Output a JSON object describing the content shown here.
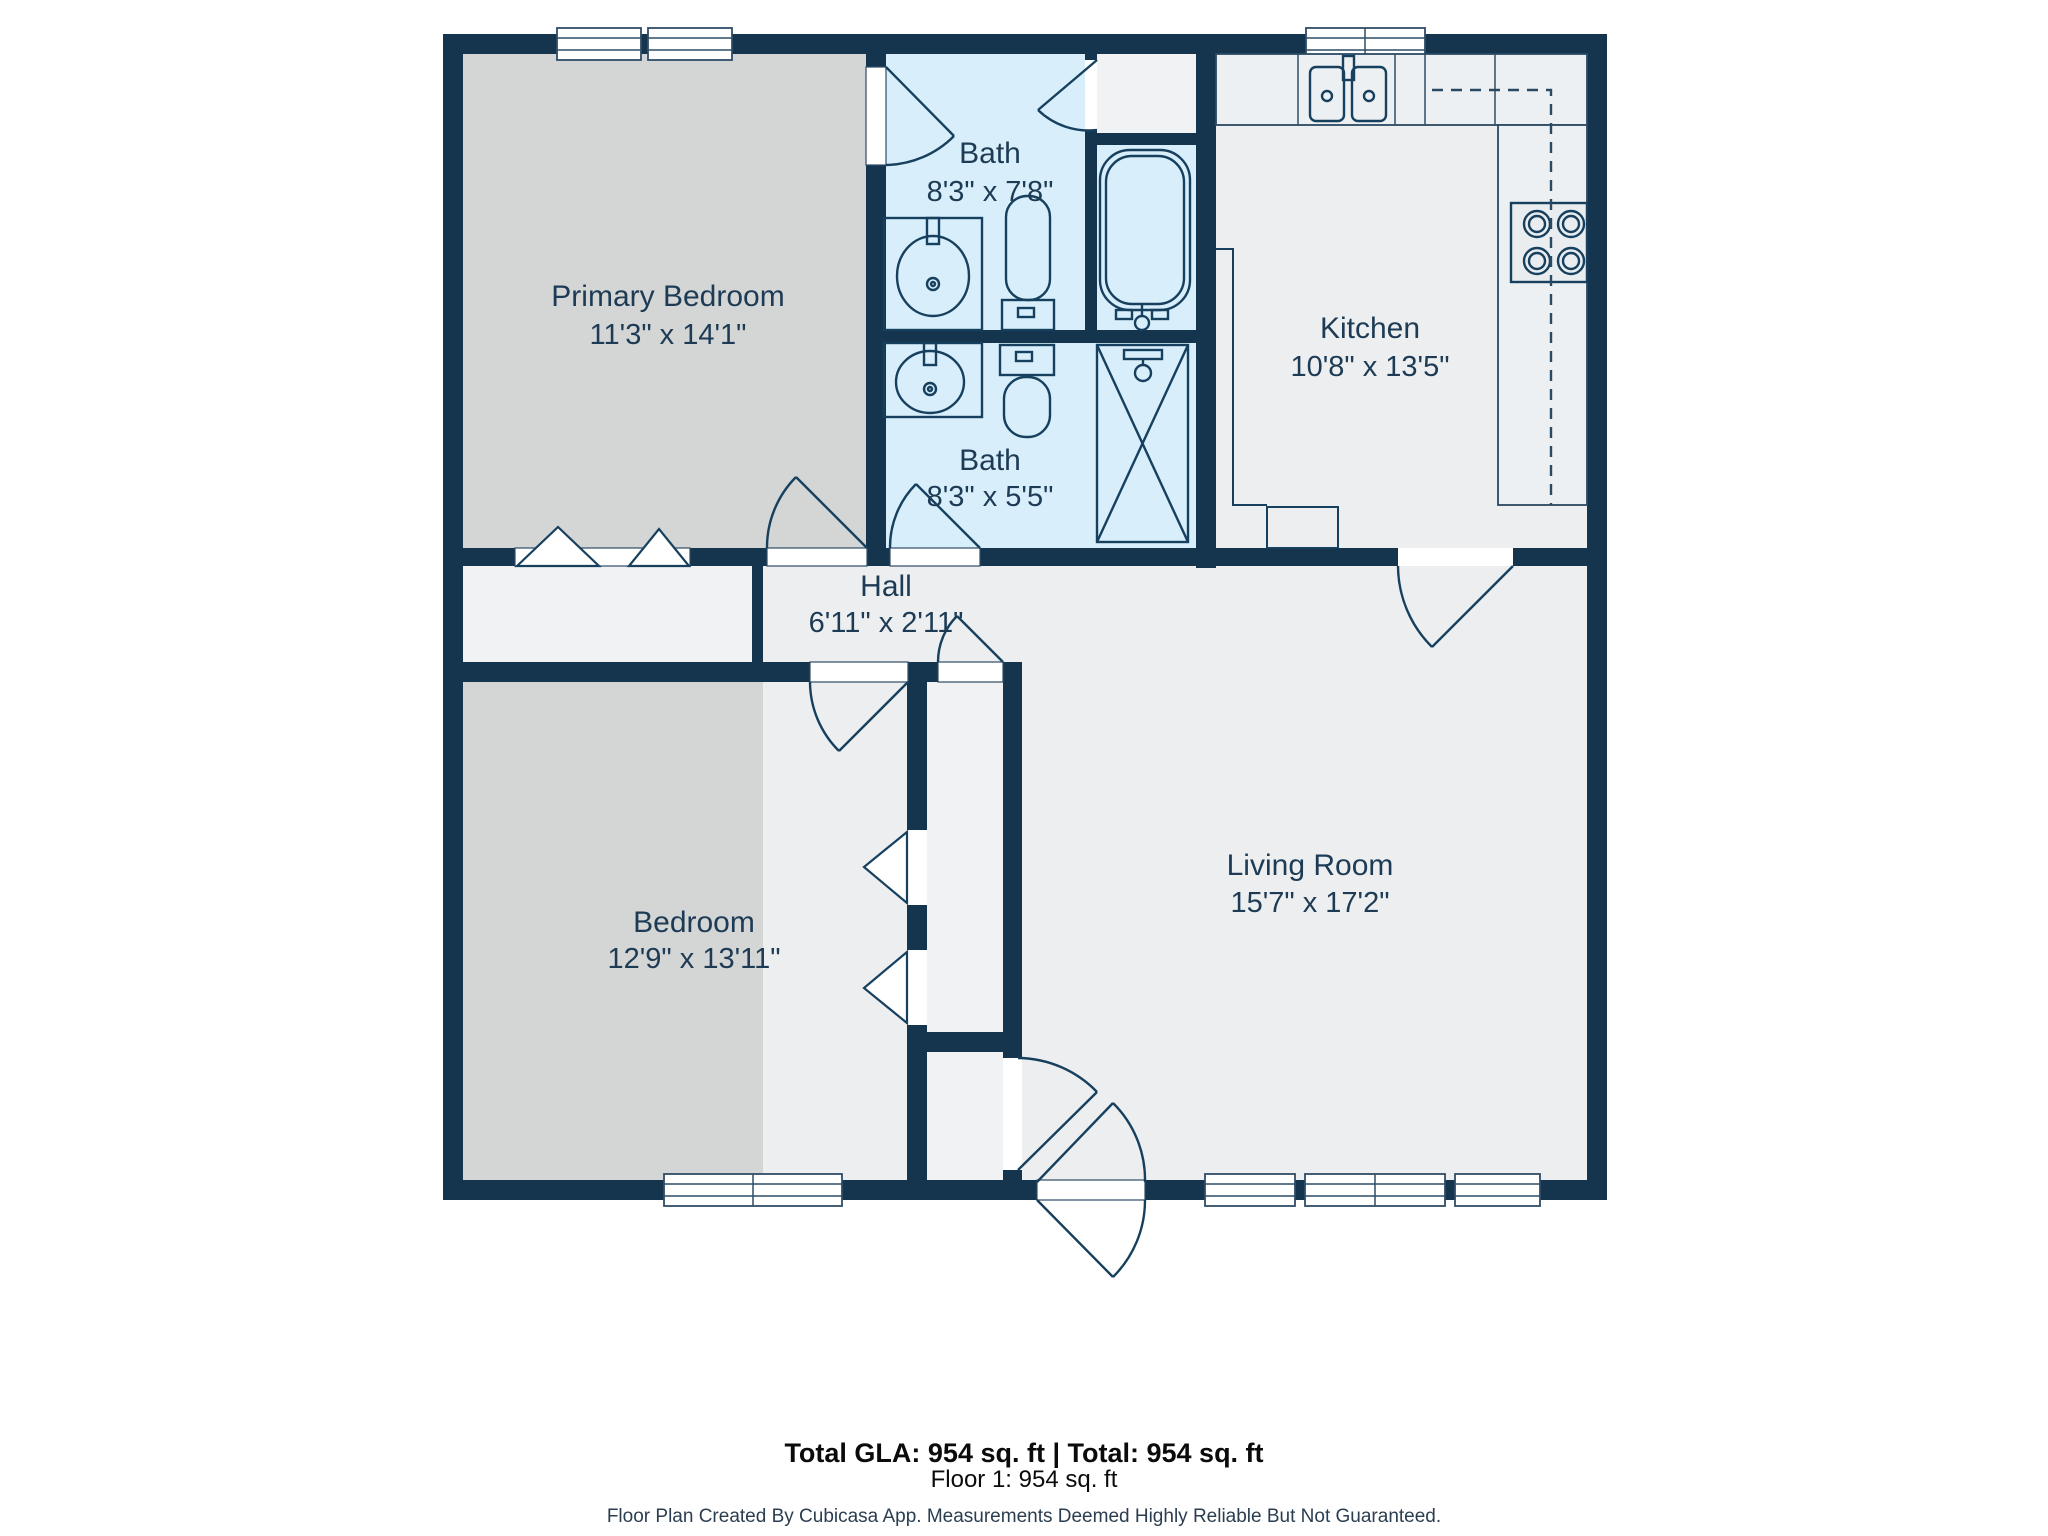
{
  "title": "Floor plan - Floor 1",
  "rooms": [
    {
      "name": "Primary Bedroom",
      "dims": "11'3\" x 14'1\""
    },
    {
      "name": "Bath",
      "dims": "8'3\" x 7'8\""
    },
    {
      "name": "Kitchen",
      "dims": "10'8\" x 13'5\""
    },
    {
      "name": "Bath",
      "dims": "8'3\" x 5'5\""
    },
    {
      "name": "Hall",
      "dims": "6'11\" x 2'11\""
    },
    {
      "name": "Bedroom",
      "dims": "12'9\" x 13'11\""
    },
    {
      "name": "Living Room",
      "dims": "15'7\" x 17'2\""
    }
  ],
  "footer": {
    "total_line": "Total GLA: 954 sq. ft | Total: 954 sq. ft",
    "floor_line": "Floor 1: 954 sq. ft",
    "disclaimer": "Floor Plan Created By Cubicasa App. Measurements Deemed Highly Reliable But Not Guaranteed."
  },
  "fixtures": [
    "bathtub-icon",
    "shower-icon",
    "toilet-icon",
    "sink-icon",
    "kitchen-sink-icon",
    "stove-icon",
    "closet-bifold-door-icon",
    "door-swing-icon",
    "window-icon"
  ],
  "colors": {
    "wall": "#15344e",
    "bedroom_floor": "#d4d5d5",
    "bath_floor": "#d8eefb",
    "main_floor": "#eceef0",
    "closet_floor": "#f0f2f3",
    "label": "#1d3b54",
    "fixture_stroke": "#16405e"
  }
}
